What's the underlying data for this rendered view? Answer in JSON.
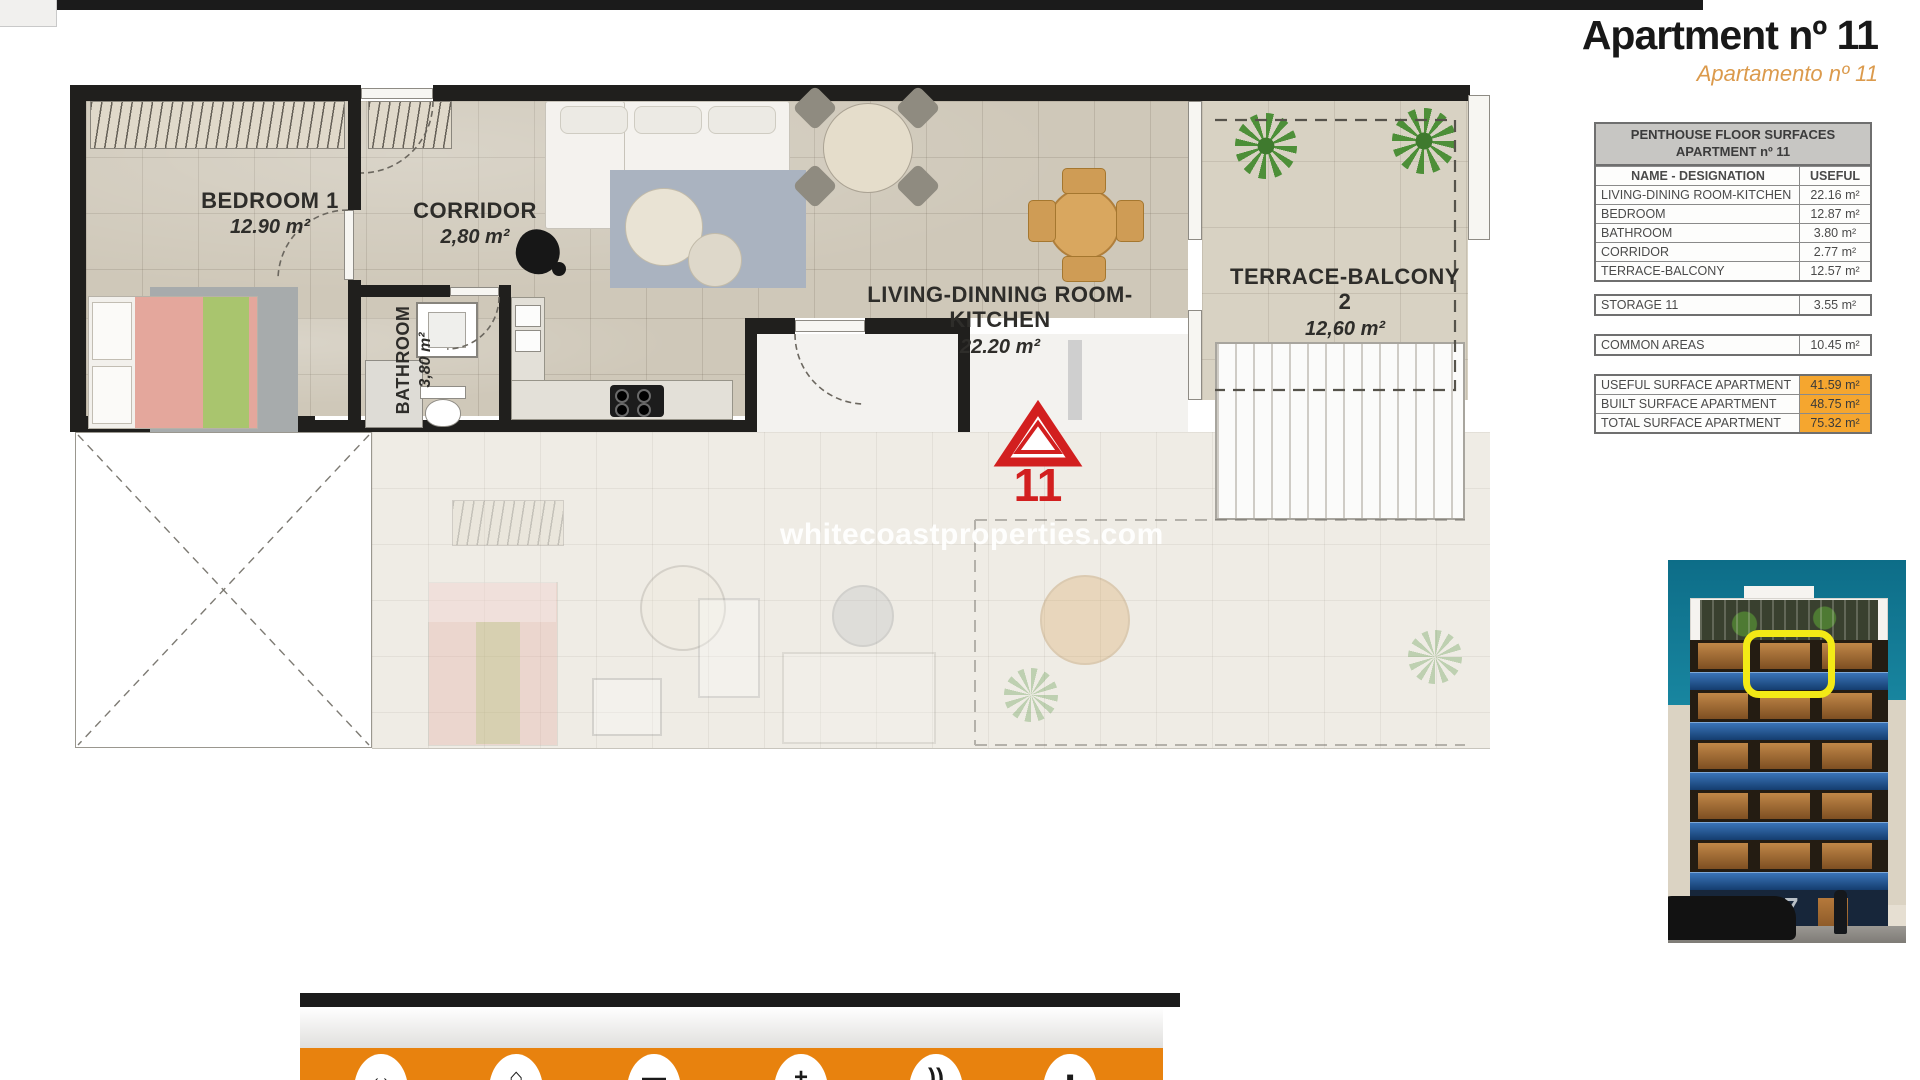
{
  "header": {
    "title": "Apartment nº 11",
    "subtitle": "Apartamento nº 11"
  },
  "plan": {
    "bedroom": {
      "name": "BEDROOM 1",
      "area": "12.90 m²"
    },
    "corridor": {
      "name": "CORRIDOR",
      "area": "2,80 m²"
    },
    "bathroom": {
      "name": "BATHROOM",
      "area": "3,80 m²"
    },
    "living": {
      "name": "LIVING-DINNING ROOM-KITCHEN",
      "area": "22.20 m²"
    },
    "terrace": {
      "name": "TERRACE-BALCONY 2",
      "area": "12,60 m²"
    },
    "unit_marker": "11",
    "watermark": "whitecoastproperties.com"
  },
  "surface_table": {
    "title_line1": "PENTHOUSE FLOOR SURFACES",
    "title_line2": "APARTMENT nº 11",
    "col_name": "NAME - DESIGNATION",
    "col_useful": "USEFUL",
    "rows": [
      {
        "name": "LIVING-DINING ROOM-KITCHEN",
        "value": "22.16 m²"
      },
      {
        "name": "BEDROOM",
        "value": "12.87 m²"
      },
      {
        "name": "BATHROOM",
        "value": "3.80 m²"
      },
      {
        "name": "CORRIDOR",
        "value": "2.77 m²"
      },
      {
        "name": "TERRACE-BALCONY",
        "value": "12.57 m²"
      }
    ],
    "storage": {
      "name": "STORAGE 11",
      "value": "3.55 m²"
    },
    "common": {
      "name": "COMMON AREAS",
      "value": "10.45 m²"
    },
    "totals": [
      {
        "name": "USEFUL SURFACE APARTMENT",
        "value": "41.59 m²"
      },
      {
        "name": "BUILT SURFACE APARTMENT",
        "value": "48.75 m²"
      },
      {
        "name": "TOTAL SURFACE APARTMENT",
        "value": "75.32 m²"
      }
    ]
  },
  "building": {
    "street_number": "17"
  },
  "footer": {
    "icons": [
      {
        "name": "dimensions-icon",
        "glyph": "↔"
      },
      {
        "name": "home-icon",
        "glyph": "⌂"
      },
      {
        "name": "bars-icon",
        "glyph": "▬"
      },
      {
        "name": "plus-icon",
        "glyph": "+"
      },
      {
        "name": "waves-icon",
        "glyph": "))"
      },
      {
        "name": "square-icon",
        "glyph": "▪"
      }
    ]
  },
  "colors": {
    "accent_orange": "#E8820E",
    "table_orange": "#F5A62F",
    "marker_red": "#D21F1F",
    "sky_teal": "#117E9A"
  }
}
